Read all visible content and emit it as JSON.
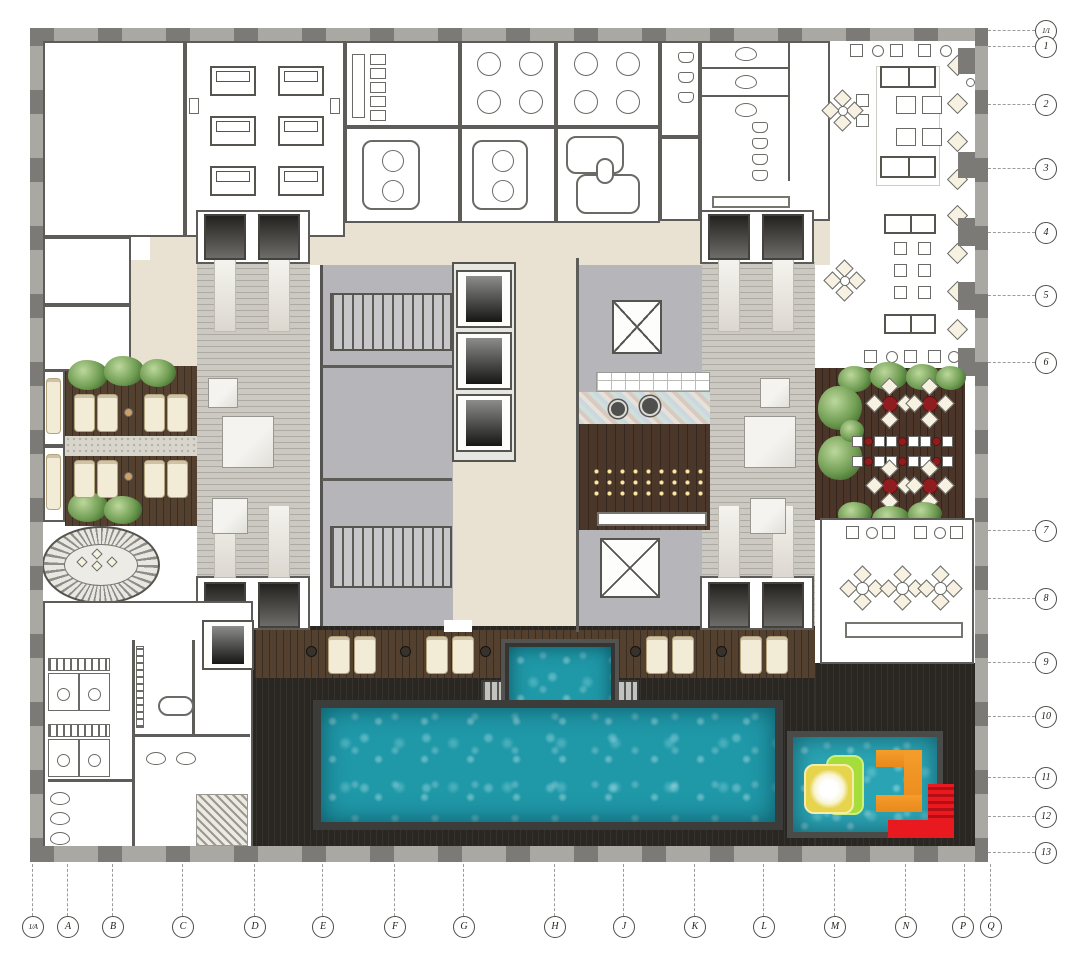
{
  "grid": {
    "right_labels": [
      "1/1",
      "1",
      "2",
      "3",
      "4",
      "5",
      "6",
      "7",
      "8",
      "9",
      "10",
      "11",
      "12",
      "13"
    ],
    "bottom_labels": [
      "1/A",
      "A",
      "B",
      "C",
      "D",
      "E",
      "F",
      "G",
      "H",
      "J",
      "K",
      "L",
      "M",
      "N",
      "P",
      "Q"
    ]
  },
  "colors": {
    "pool_water": "#1f98a8",
    "kids_water": "#2aa4b4",
    "pool_deck": "#2a2722",
    "wood_deck": "#53402f",
    "terrace_wood": "#4a3528",
    "bar_wood": "#4a3729",
    "beige": "#e9e2d2",
    "core_gray": "#b6b5b9",
    "stone": "#ccc9c2",
    "column_gray": "#7b7a76",
    "plant_green": "#6f9c52",
    "table_red": "#8f1d1f",
    "slide_red": "#e8191f",
    "slide_orange": "#e8891c",
    "play_yellow": "#e5d44c",
    "play_lime": "#a5dd3a",
    "lounger_cream": "#f2ecd6",
    "marble_white": "#f0efec"
  }
}
